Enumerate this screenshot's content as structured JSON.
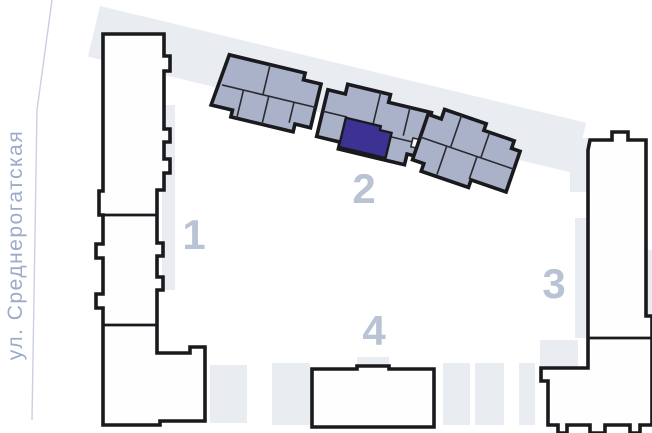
{
  "plan": {
    "title": "residential-complex-site-plan",
    "street": {
      "label": "ул. Среднерогатская"
    },
    "buildings": [
      {
        "number": "1",
        "highlighted": false
      },
      {
        "number": "2",
        "highlighted": true,
        "has_selected_unit": true
      },
      {
        "number": "3",
        "highlighted": false
      },
      {
        "number": "4",
        "highlighted": false
      }
    ]
  },
  "colors": {
    "background": "#ffffff",
    "outline": "#1a1a1e",
    "building-fill": "#fefefe",
    "selected-building-fill": "#a9b2c8",
    "unit-line": "#2a2a31",
    "selected-unit-fill": "#3c3294",
    "shadow": "#e9edf2",
    "label": "#b9c3d4",
    "street-label": "#9daac9",
    "street-line": "#c9d0e0"
  }
}
